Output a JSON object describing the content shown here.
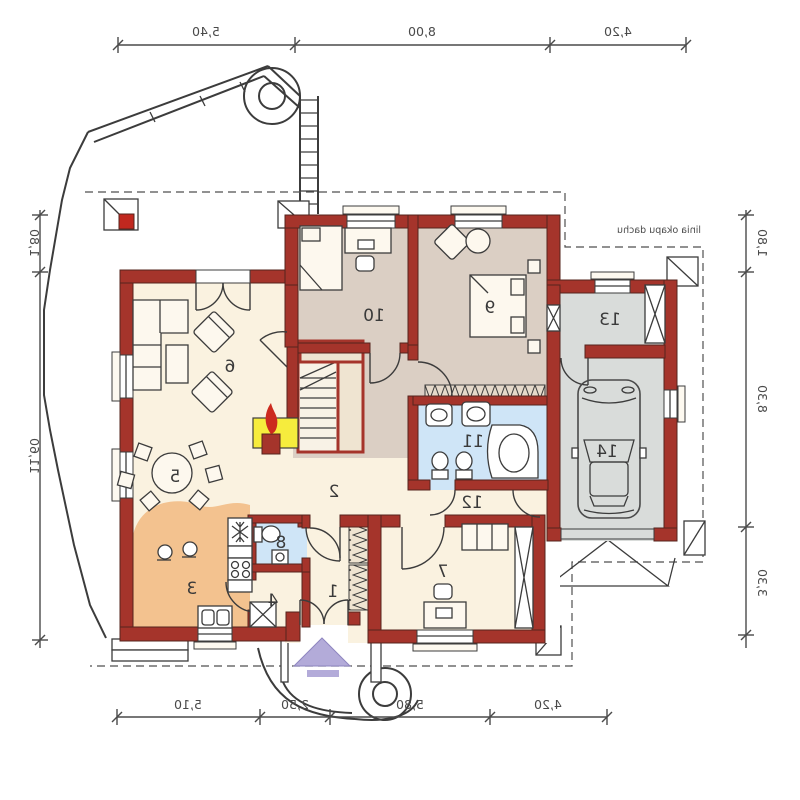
{
  "plan": {
    "annotation": "linia okapu dachu",
    "rooms": [
      {
        "number": "1"
      },
      {
        "number": "2"
      },
      {
        "number": "3"
      },
      {
        "number": "4"
      },
      {
        "number": "5"
      },
      {
        "number": "6"
      },
      {
        "number": "7"
      },
      {
        "number": "8"
      },
      {
        "number": "9"
      },
      {
        "number": "10"
      },
      {
        "number": "11"
      },
      {
        "number": "12"
      },
      {
        "number": "13"
      },
      {
        "number": "14"
      }
    ],
    "dimensions": {
      "top": [
        "5,40",
        "8,00",
        "4,20"
      ],
      "bottom": [
        "5,10",
        "2,50",
        "5,80",
        "4,20"
      ],
      "left": [
        "1,80",
        "11,60"
      ],
      "right": [
        "1,80",
        "8,30",
        "3,30"
      ]
    },
    "colors": {
      "wall": "#a5342b",
      "floor_main": "#faf2e0",
      "floor_bedroom": "#dbcfc4",
      "floor_bath": "#cfe5f7",
      "floor_kitchen": "#f3c28f",
      "floor_garage": "#d9dcda",
      "fireplace": "#f6ec3d",
      "flame": "#cc2a1e",
      "entrance_arrow": "#b3abd9",
      "line": "#3c3c3c"
    }
  }
}
